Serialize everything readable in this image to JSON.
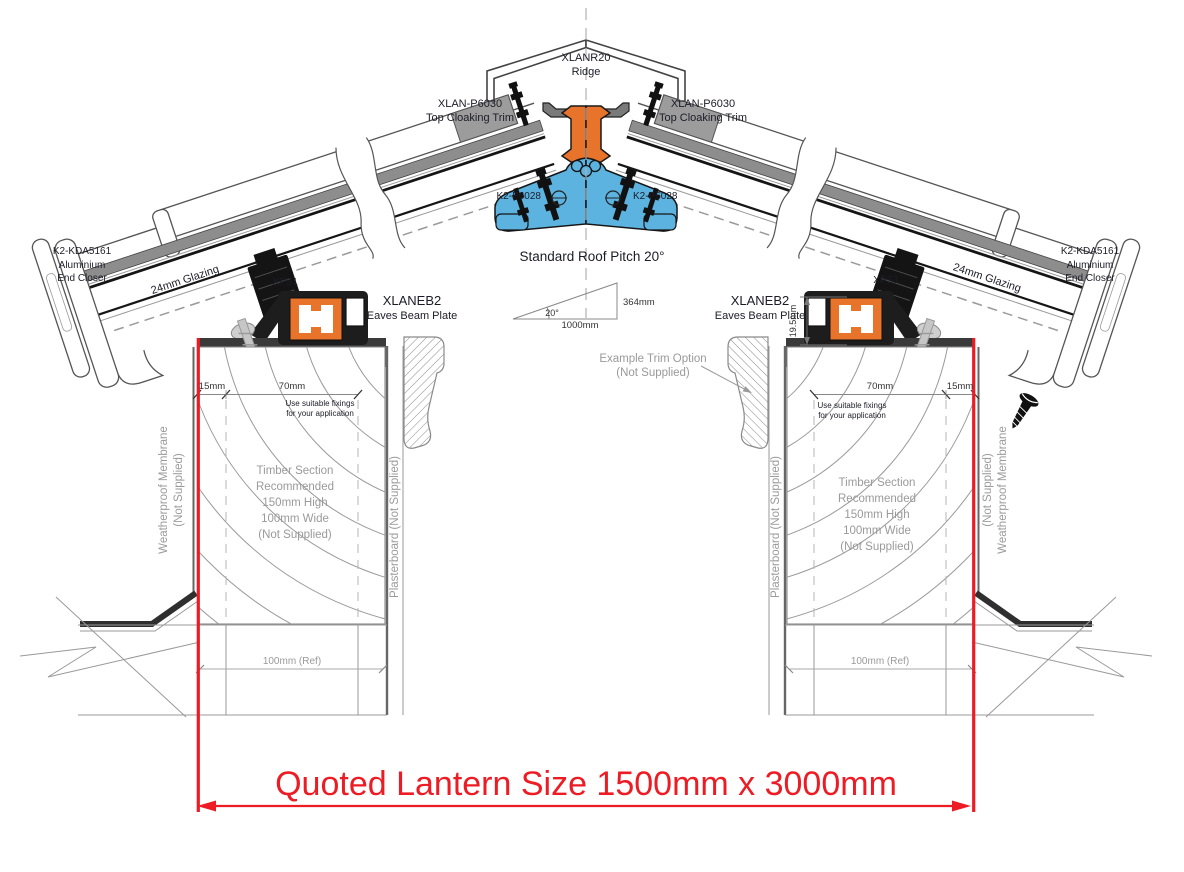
{
  "labels": {
    "ridge": {
      "part": "XLANR20",
      "name": "Ridge"
    },
    "top_cloaking_trim": {
      "part": "XLAN-P6030",
      "name": "Top Cloaking Trim"
    },
    "ridge_fixing": {
      "part": "K2-P6028"
    },
    "pitch": {
      "note": "Standard Roof Pitch 20°",
      "angle": "20°",
      "rise": "364mm",
      "run": "1000mm"
    },
    "end_closer": {
      "part": "K2-KDA5161",
      "material": "Aluminium",
      "name": "End Closer"
    },
    "glazing": {
      "name": "24mm Glazing"
    },
    "xps": {
      "name": "XPS1"
    },
    "eaves_beam": {
      "part": "XLANEB2",
      "name": "Eaves Beam Plate"
    },
    "dims": {
      "edge_offset": "15mm",
      "fixing_zone": "70mm",
      "beam_height": "19.5mm",
      "wall_ref": "100mm (Ref)"
    },
    "fixings_note": {
      "line1": "Use suitable fixings",
      "line2": "for your application"
    },
    "timber_note": {
      "line1": "Timber Section",
      "line2": "Recommended",
      "line3": "150mm High",
      "line4": "100mm Wide",
      "line5": "(Not Supplied)"
    },
    "membrane": {
      "line1": "Weatherproof Membrane",
      "line2": "(Not Supplied)"
    },
    "plasterboard": {
      "name": "Plasterboard (Not Supplied)"
    },
    "trim_option": {
      "line1": "Example Trim Option",
      "line2": "(Not Supplied)"
    },
    "quoted_size": "Quoted Lantern Size 1500mm x 3000mm"
  },
  "colors": {
    "dimension_red": "#ed1c24",
    "thermal_break_orange": "#e8732a",
    "gasket_blue": "#5db3e0",
    "line_dark": "#4a4a4a",
    "label_gray": "#9a9a9a"
  }
}
